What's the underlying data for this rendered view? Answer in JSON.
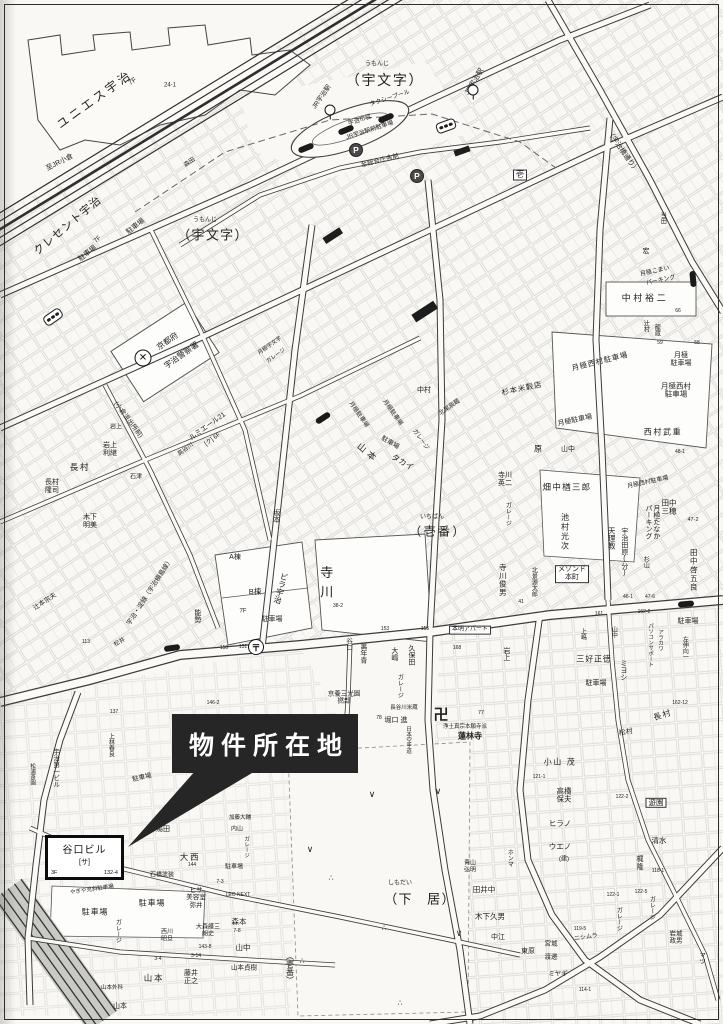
{
  "callout": {
    "label": "物件所在地"
  },
  "property": {
    "name": "谷口ビル",
    "unit": "[サ]",
    "floors": "3F",
    "lot": "132-4"
  },
  "colors": {
    "ink": "#222222",
    "paper": "#f9f8f4",
    "callout_bg": "#262626",
    "callout_text": "#ffffff"
  },
  "labels": [
    {
      "t": "ユニエス宇治",
      "x": 95,
      "y": 100,
      "s": 12,
      "r": -36,
      "ls": 0.25
    },
    {
      "t": "7F",
      "x": 133,
      "y": 82,
      "s": 7,
      "r": -36
    },
    {
      "t": "24-1",
      "x": 170,
      "y": 86,
      "s": 6
    },
    {
      "t": "至JR小倉",
      "x": 60,
      "y": 163,
      "s": 7,
      "r": -27
    },
    {
      "t": "うもんじ",
      "x": 377,
      "y": 65,
      "s": 6
    },
    {
      "t": "（宇文字）",
      "x": 385,
      "y": 81,
      "s": 14,
      "ls": 0.12
    },
    {
      "t": "タクシープール",
      "x": 390,
      "y": 99,
      "s": 6,
      "r": -18
    },
    {
      "t": "JR宇治駅",
      "x": 322,
      "y": 97,
      "s": 6.5,
      "r": -55
    },
    {
      "t": "JR宇治駅",
      "x": 475,
      "y": 82,
      "s": 7,
      "r": -58
    },
    {
      "t": "宇治市営",
      "x": 360,
      "y": 121,
      "s": 6,
      "r": -18
    },
    {
      "t": "JR宇治駅前駐車場",
      "x": 370,
      "y": 131,
      "s": 6,
      "r": -18
    },
    {
      "t": "至総合庁舎前",
      "x": 380,
      "y": 161,
      "s": 6.5,
      "r": -14
    },
    {
      "t": "森田",
      "x": 190,
      "y": 163,
      "s": 6,
      "r": -35
    },
    {
      "t": "うもんじ",
      "x": 205,
      "y": 221,
      "s": 6
    },
    {
      "t": "（宇文字）",
      "x": 213,
      "y": 236,
      "s": 13,
      "ls": 0.1
    },
    {
      "t": "クレセント宇治",
      "x": 68,
      "y": 226,
      "s": 11,
      "r": -40,
      "ls": 0.1
    },
    {
      "t": "7F",
      "x": 98,
      "y": 240,
      "s": 6,
      "r": -40
    },
    {
      "t": "駐車場",
      "x": 136,
      "y": 227,
      "s": 7,
      "r": -38
    },
    {
      "t": "駐車場",
      "x": 88,
      "y": 254,
      "s": 7,
      "r": -38
    },
    {
      "t": "壱",
      "x": 520,
      "y": 175,
      "s": 8,
      "box": 1
    },
    {
      "t": "当田",
      "x": 662,
      "y": 218,
      "s": 6,
      "v": 1
    },
    {
      "t": "宏",
      "x": 646,
      "y": 252,
      "s": 7
    },
    {
      "t": "（宇治橋通り）",
      "x": 622,
      "y": 152,
      "s": 7,
      "r": 55
    },
    {
      "t": "京都府",
      "x": 168,
      "y": 342,
      "s": 8,
      "r": -35
    },
    {
      "t": "宇治警察署",
      "x": 182,
      "y": 356,
      "s": 8,
      "r": -35
    },
    {
      "t": "月極宇文字",
      "x": 270,
      "y": 346,
      "s": 5.5,
      "r": -35
    },
    {
      "t": "ガレージ",
      "x": 276,
      "y": 356,
      "s": 5.5,
      "r": -35
    },
    {
      "t": "中村裕二",
      "x": 645,
      "y": 298,
      "s": 9,
      "ls": 0.3
    },
    {
      "t": "月極こまい",
      "x": 655,
      "y": 272,
      "s": 6,
      "r": -12
    },
    {
      "t": "パーキング",
      "x": 661,
      "y": 281,
      "s": 6,
      "r": -12
    },
    {
      "t": "辻村",
      "x": 645,
      "y": 326,
      "s": 6,
      "v": 1
    },
    {
      "t": "龍蔵",
      "x": 656,
      "y": 330,
      "s": 6,
      "v": 1
    },
    {
      "t": "月極西村駐車場",
      "x": 600,
      "y": 362,
      "s": 7.5,
      "r": -14,
      "ls": 0.1
    },
    {
      "t": "月極\n駐車場",
      "x": 681,
      "y": 360,
      "s": 7
    },
    {
      "t": "月極西村\n駐車場",
      "x": 676,
      "y": 391,
      "s": 7.5
    },
    {
      "t": "西村武重",
      "x": 663,
      "y": 433,
      "s": 8,
      "ls": 0.2
    },
    {
      "t": "66",
      "x": 678,
      "y": 312,
      "s": 5
    },
    {
      "t": "59",
      "x": 660,
      "y": 344,
      "s": 5
    },
    {
      "t": "58",
      "x": 697,
      "y": 344,
      "s": 5
    },
    {
      "t": "48-1",
      "x": 680,
      "y": 453,
      "s": 5
    },
    {
      "t": "中村",
      "x": 424,
      "y": 391,
      "s": 7
    },
    {
      "t": "北尾辰蔵",
      "x": 450,
      "y": 408,
      "s": 6,
      "r": -35
    },
    {
      "t": "杉本米穀店",
      "x": 522,
      "y": 389,
      "s": 7.5,
      "r": -12,
      "ls": 0.1
    },
    {
      "t": "月極駐車場",
      "x": 575,
      "y": 421,
      "s": 7,
      "r": -12
    },
    {
      "t": "原",
      "x": 538,
      "y": 450,
      "s": 8
    },
    {
      "t": "山中",
      "x": 568,
      "y": 450,
      "s": 7
    },
    {
      "t": "寺川\n英二",
      "x": 505,
      "y": 480,
      "s": 7
    },
    {
      "t": "ガレージ",
      "x": 507,
      "y": 514,
      "s": 6,
      "v": 1
    },
    {
      "t": "畑中楢三郎",
      "x": 567,
      "y": 488,
      "s": 8.5,
      "ls": 0.15
    },
    {
      "t": "月極西村駐車場",
      "x": 648,
      "y": 483,
      "s": 6,
      "r": -12
    },
    {
      "t": "池村光次",
      "x": 564,
      "y": 532,
      "s": 8,
      "v": 1,
      "ls": 0.2
    },
    {
      "t": "天理教",
      "x": 611,
      "y": 538,
      "s": 7.5,
      "v": 1
    },
    {
      "t": "宇治田原(分)",
      "x": 624,
      "y": 552,
      "s": 7,
      "v": 1
    },
    {
      "t": "月極たなか\nパーキング",
      "x": 652,
      "y": 522,
      "s": 7,
      "v": 1
    },
    {
      "t": "田中\n三穂",
      "x": 669,
      "y": 508,
      "s": 7.5
    },
    {
      "t": "47-2",
      "x": 693,
      "y": 520,
      "s": 5.5
    },
    {
      "t": "田中啓五良",
      "x": 693,
      "y": 570,
      "s": 7.5,
      "v": 1,
      "ls": 0.15
    },
    {
      "t": "メゾンド\n本町",
      "x": 572,
      "y": 574,
      "s": 7,
      "box": 1
    },
    {
      "t": "寺川俊男",
      "x": 502,
      "y": 580,
      "s": 7.5,
      "v": 1,
      "ls": 0.1
    },
    {
      "t": "北景源太郎",
      "x": 533,
      "y": 582,
      "s": 6,
      "v": 1
    },
    {
      "t": "杉山",
      "x": 645,
      "y": 562,
      "s": 6,
      "v": 1
    },
    {
      "t": "駐車場",
      "x": 688,
      "y": 622,
      "s": 7
    },
    {
      "t": "寺川",
      "x": 325,
      "y": 585,
      "s": 13,
      "v": 1,
      "ls": 0.5
    },
    {
      "t": "A棟",
      "x": 235,
      "y": 558,
      "s": 7
    },
    {
      "t": "B棟",
      "x": 255,
      "y": 592,
      "s": 7.5
    },
    {
      "t": "ビラ宇治",
      "x": 280,
      "y": 588,
      "s": 8,
      "v": 1,
      "r": 15
    },
    {
      "t": "7F",
      "x": 243,
      "y": 612,
      "s": 6
    },
    {
      "t": "駐車場",
      "x": 272,
      "y": 620,
      "s": 7
    },
    {
      "t": "能勢",
      "x": 197,
      "y": 616,
      "s": 7,
      "v": 1
    },
    {
      "t": "宇治・淀線（宇治槇島線）",
      "x": 150,
      "y": 592,
      "s": 6.5,
      "r": -57
    },
    {
      "t": "(小倉派出所前)",
      "x": 128,
      "y": 420,
      "s": 6.5,
      "r": 53
    },
    {
      "t": "ルミエール21",
      "x": 208,
      "y": 427,
      "s": 7,
      "r": -36
    },
    {
      "t": "[ク] 6F",
      "x": 213,
      "y": 440,
      "s": 6,
      "r": -36
    },
    {
      "t": "高谷川",
      "x": 186,
      "y": 450,
      "s": 6,
      "r": -36
    },
    {
      "t": "長村",
      "x": 80,
      "y": 468,
      "s": 8.5,
      "ls": 0.2
    },
    {
      "t": "長村\n隆司",
      "x": 52,
      "y": 487,
      "s": 7
    },
    {
      "t": "岩上\n利継",
      "x": 110,
      "y": 450,
      "s": 7
    },
    {
      "t": "岩上",
      "x": 116,
      "y": 428,
      "s": 6
    },
    {
      "t": "木下\n明美",
      "x": 90,
      "y": 522,
      "s": 7
    },
    {
      "t": "石津",
      "x": 136,
      "y": 478,
      "s": 6
    },
    {
      "t": "山本",
      "x": 368,
      "y": 453,
      "s": 9,
      "r": 40,
      "ls": 0.4
    },
    {
      "t": "タカイ",
      "x": 402,
      "y": 463,
      "s": 8,
      "r": 30
    },
    {
      "t": "駐車場",
      "x": 390,
      "y": 443,
      "s": 6.5,
      "r": 30
    },
    {
      "t": "月極駐車場",
      "x": 358,
      "y": 415,
      "s": 6,
      "r": 55
    },
    {
      "t": "月極駐車場",
      "x": 392,
      "y": 413,
      "s": 6,
      "r": 55
    },
    {
      "t": "ガレージ",
      "x": 420,
      "y": 440,
      "s": 6,
      "r": 55
    },
    {
      "t": "坂本",
      "x": 276,
      "y": 516,
      "s": 7,
      "v": 1
    },
    {
      "t": "いちばん",
      "x": 432,
      "y": 518,
      "s": 6
    },
    {
      "t": "（壱番）",
      "x": 438,
      "y": 532,
      "s": 12,
      "ls": 0.2
    },
    {
      "t": "萬年青",
      "x": 363,
      "y": 653,
      "s": 7,
      "v": 1
    },
    {
      "t": "谷口",
      "x": 348,
      "y": 644,
      "s": 6.5,
      "v": 1
    },
    {
      "t": "大嶋",
      "x": 394,
      "y": 654,
      "s": 7,
      "v": 1
    },
    {
      "t": "久保田",
      "x": 411,
      "y": 655,
      "s": 7,
      "v": 1
    },
    {
      "t": "本明アパート",
      "x": 470,
      "y": 630,
      "s": 6,
      "box": 1
    },
    {
      "t": "岩上",
      "x": 506,
      "y": 654,
      "s": 7,
      "v": 1
    },
    {
      "t": "ガレージ",
      "x": 399,
      "y": 686,
      "s": 6,
      "v": 1
    },
    {
      "t": "京養三光園\n撚部",
      "x": 344,
      "y": 698,
      "s": 6.5
    },
    {
      "t": "長谷川米蔵",
      "x": 404,
      "y": 708,
      "s": 5.5
    },
    {
      "t": "堀口 進",
      "x": 396,
      "y": 721,
      "s": 7
    },
    {
      "t": "卍",
      "x": 441,
      "y": 716,
      "s": 15,
      "b": 1
    },
    {
      "t": "浄土真宗本願寺派",
      "x": 465,
      "y": 727,
      "s": 5.5
    },
    {
      "t": "蓮林寺",
      "x": 470,
      "y": 737,
      "s": 8,
      "b": 1
    },
    {
      "t": "日本空手道",
      "x": 408,
      "y": 740,
      "s": 5.5,
      "v": 1
    },
    {
      "t": "77",
      "x": 481,
      "y": 713,
      "s": 5.5
    },
    {
      "t": "78",
      "x": 379,
      "y": 719,
      "s": 5
    },
    {
      "t": "153",
      "x": 385,
      "y": 630,
      "s": 5
    },
    {
      "t": "155",
      "x": 425,
      "y": 630,
      "s": 5
    },
    {
      "t": "168",
      "x": 457,
      "y": 649,
      "s": 5
    },
    {
      "t": "三好正徳",
      "x": 594,
      "y": 660,
      "s": 8,
      "ls": 0.1
    },
    {
      "t": "ミヨシ",
      "x": 623,
      "y": 670,
      "s": 7,
      "v": 1
    },
    {
      "t": "駐車場",
      "x": 596,
      "y": 684,
      "s": 7
    },
    {
      "t": "左伸向一",
      "x": 684,
      "y": 648,
      "s": 6,
      "v": 1
    },
    {
      "t": "パソコンサポート",
      "x": 650,
      "y": 645,
      "s": 5.5,
      "v": 1
    },
    {
      "t": "アラカワ",
      "x": 660,
      "y": 640,
      "s": 5.5,
      "v": 1
    },
    {
      "t": "山中",
      "x": 613,
      "y": 632,
      "s": 6,
      "v": 1
    },
    {
      "t": "上嶋",
      "x": 582,
      "y": 634,
      "s": 6,
      "v": 1
    },
    {
      "t": "161",
      "x": 599,
      "y": 615,
      "s": 5
    },
    {
      "t": "162-2",
      "x": 644,
      "y": 613,
      "s": 5
    },
    {
      "t": "150",
      "x": 224,
      "y": 649,
      "s": 5
    },
    {
      "t": "151",
      "x": 243,
      "y": 648,
      "s": 5
    },
    {
      "t": "38-2",
      "x": 338,
      "y": 607,
      "s": 5
    },
    {
      "t": "47-6",
      "x": 650,
      "y": 598,
      "s": 5
    },
    {
      "t": "46-1",
      "x": 628,
      "y": 598,
      "s": 5
    },
    {
      "t": "41",
      "x": 521,
      "y": 603,
      "s": 5
    },
    {
      "t": "162-12",
      "x": 680,
      "y": 704,
      "s": 5
    },
    {
      "t": "長村",
      "x": 663,
      "y": 716,
      "s": 8,
      "r": -18,
      "ls": 0.2
    },
    {
      "t": "松村",
      "x": 626,
      "y": 733,
      "s": 7,
      "r": -10
    },
    {
      "t": "小山 茂",
      "x": 560,
      "y": 763,
      "s": 8,
      "ls": 0.2
    },
    {
      "t": "高橋\n保夫",
      "x": 564,
      "y": 796,
      "s": 7.5
    },
    {
      "t": "ヒラノ",
      "x": 560,
      "y": 824,
      "s": 7.5
    },
    {
      "t": "ウエノ",
      "x": 560,
      "y": 847,
      "s": 7.5
    },
    {
      "t": "(建)",
      "x": 564,
      "y": 860,
      "s": 6
    },
    {
      "t": "遊園",
      "x": 656,
      "y": 803,
      "s": 7.5,
      "box": 1
    },
    {
      "t": "清水",
      "x": 659,
      "y": 841,
      "s": 7.5
    },
    {
      "t": "121-1",
      "x": 539,
      "y": 778,
      "s": 5
    },
    {
      "t": "122-2",
      "x": 622,
      "y": 798,
      "s": 5
    },
    {
      "t": "梶\n隆",
      "x": 640,
      "y": 864,
      "s": 7
    },
    {
      "t": "ガレージ",
      "x": 651,
      "y": 908,
      "s": 6,
      "v": 1
    },
    {
      "t": "ガレージ",
      "x": 618,
      "y": 919,
      "s": 6,
      "v": 1
    },
    {
      "t": "ニシムラ",
      "x": 586,
      "y": 938,
      "s": 6,
      "r": -8
    },
    {
      "t": "宮城",
      "x": 551,
      "y": 944,
      "s": 6.5
    },
    {
      "t": "渡邊",
      "x": 551,
      "y": 957,
      "s": 6.5
    },
    {
      "t": "ミヤギ",
      "x": 558,
      "y": 974,
      "s": 6.5
    },
    {
      "t": "岩城\n政男",
      "x": 676,
      "y": 938,
      "s": 6.5
    },
    {
      "t": "マツ",
      "x": 701,
      "y": 958,
      "s": 6.5,
      "v": 1
    },
    {
      "t": "122-1",
      "x": 613,
      "y": 896,
      "s": 5
    },
    {
      "t": "122-5",
      "x": 641,
      "y": 893,
      "s": 5
    },
    {
      "t": "118-1",
      "x": 658,
      "y": 872,
      "s": 5
    },
    {
      "t": "119-5",
      "x": 580,
      "y": 930,
      "s": 5
    },
    {
      "t": "114-1",
      "x": 585,
      "y": 991,
      "s": 5
    },
    {
      "t": "しもだい",
      "x": 400,
      "y": 884,
      "s": 6
    },
    {
      "t": "（下　居）",
      "x": 420,
      "y": 900,
      "s": 13,
      "ls": 0.1
    },
    {
      "t": "青山\n弘明",
      "x": 470,
      "y": 867,
      "s": 6
    },
    {
      "t": "田井中",
      "x": 484,
      "y": 890,
      "s": 7.5
    },
    {
      "t": "木下久男",
      "x": 490,
      "y": 917,
      "s": 7.5
    },
    {
      "t": "ホンマ",
      "x": 509,
      "y": 858,
      "s": 6,
      "v": 1
    },
    {
      "t": "中江",
      "x": 498,
      "y": 938,
      "s": 7
    },
    {
      "t": "東原",
      "x": 528,
      "y": 952,
      "s": 7
    },
    {
      "t": "湯田",
      "x": 163,
      "y": 830,
      "s": 7
    },
    {
      "t": "大西",
      "x": 190,
      "y": 858,
      "s": 8.5,
      "ls": 0.2
    },
    {
      "t": "石橋塗装",
      "x": 162,
      "y": 876,
      "s": 6
    },
    {
      "t": "ヒサ\n美容室\n弥井",
      "x": 196,
      "y": 898,
      "s": 6.5
    },
    {
      "t": "やぎや児斜駐車場",
      "x": 92,
      "y": 890,
      "s": 5.5,
      "r": -8
    },
    {
      "t": "駐車場",
      "x": 95,
      "y": 913,
      "s": 8,
      "ls": 0.1
    },
    {
      "t": "駐車場",
      "x": 152,
      "y": 904,
      "s": 8,
      "ls": 0.1
    },
    {
      "t": "西川\n昭旦",
      "x": 167,
      "y": 936,
      "s": 6
    },
    {
      "t": "大森護三\n朗史",
      "x": 208,
      "y": 931,
      "s": 6
    },
    {
      "t": "森本",
      "x": 239,
      "y": 922,
      "s": 7.5
    },
    {
      "t": "山中",
      "x": 243,
      "y": 948,
      "s": 7.5
    },
    {
      "t": "山本貞樹",
      "x": 244,
      "y": 968,
      "s": 6.5
    },
    {
      "t": "山本",
      "x": 154,
      "y": 979,
      "s": 8.5,
      "ls": 0.2
    },
    {
      "t": "藤井\n正之",
      "x": 191,
      "y": 978,
      "s": 7
    },
    {
      "t": "ガレージ",
      "x": 117,
      "y": 931,
      "s": 6,
      "v": 1
    },
    {
      "t": "LEO NEXT",
      "x": 238,
      "y": 896,
      "s": 5
    },
    {
      "t": "山本外科",
      "x": 112,
      "y": 988,
      "s": 5.5
    },
    {
      "t": "山本",
      "x": 120,
      "y": 1007,
      "s": 7
    },
    {
      "t": "7-8",
      "x": 237,
      "y": 932,
      "s": 5
    },
    {
      "t": "143-8",
      "x": 205,
      "y": 948,
      "s": 5
    },
    {
      "t": "3-4",
      "x": 158,
      "y": 960,
      "s": 5
    },
    {
      "t": "3-14",
      "x": 196,
      "y": 957,
      "s": 5
    },
    {
      "t": "144",
      "x": 192,
      "y": 866,
      "s": 5
    },
    {
      "t": "7-3",
      "x": 220,
      "y": 883,
      "s": 5
    },
    {
      "t": "146-2",
      "x": 213,
      "y": 704,
      "s": 5
    },
    {
      "t": "加藤大輔",
      "x": 240,
      "y": 818,
      "s": 5.5
    },
    {
      "t": "内山",
      "x": 237,
      "y": 830,
      "s": 6
    },
    {
      "t": "ガレージ",
      "x": 246,
      "y": 847,
      "s": 5.5,
      "v": 1
    },
    {
      "t": "駐車場",
      "x": 234,
      "y": 868,
      "s": 6
    },
    {
      "t": "宇治第一ビル",
      "x": 55,
      "y": 768,
      "s": 6.5,
      "v": 1
    },
    {
      "t": "上林春良",
      "x": 110,
      "y": 745,
      "s": 6,
      "v": 1
    },
    {
      "t": "松浦茶園",
      "x": 32,
      "y": 774,
      "s": 5.5,
      "v": 1
    },
    {
      "t": "駐車場",
      "x": 142,
      "y": 778,
      "s": 6.5,
      "r": -12
    },
    {
      "t": "辻本宗夫",
      "x": 45,
      "y": 602,
      "s": 6.5,
      "r": -33
    },
    {
      "t": "松井",
      "x": 120,
      "y": 643,
      "s": 6,
      "r": -30
    },
    {
      "t": "137",
      "x": 114,
      "y": 713,
      "s": 5
    },
    {
      "t": "113",
      "x": 86,
      "y": 643,
      "s": 5
    },
    {
      "t": "（壱番）",
      "x": 289,
      "y": 968,
      "s": 8,
      "v": 1
    },
    {
      "t": "∨",
      "x": 372,
      "y": 794,
      "s": 9
    },
    {
      "t": "∨",
      "x": 438,
      "y": 791,
      "s": 9
    },
    {
      "t": "∨",
      "x": 310,
      "y": 849,
      "s": 9
    },
    {
      "t": "∨",
      "x": 459,
      "y": 933,
      "s": 9
    },
    {
      "t": "∴",
      "x": 331,
      "y": 879,
      "s": 8
    },
    {
      "t": "∴",
      "x": 384,
      "y": 929,
      "s": 8
    },
    {
      "t": "∴",
      "x": 400,
      "y": 1004,
      "s": 8
    },
    {
      "t": "∴",
      "x": 302,
      "y": 962,
      "s": 8
    }
  ],
  "icons": [
    {
      "type": "police",
      "x": 143,
      "y": 358,
      "glyph": "✕"
    },
    {
      "type": "post",
      "x": 256,
      "y": 647,
      "glyph": "〒"
    },
    {
      "type": "parking",
      "x": 356,
      "y": 150,
      "glyph": "P"
    },
    {
      "type": "parking",
      "x": 417,
      "y": 176,
      "glyph": "P"
    },
    {
      "type": "signal",
      "x": 53,
      "y": 317,
      "r": -35
    },
    {
      "type": "signal",
      "x": 446,
      "y": 126,
      "r": -20
    },
    {
      "type": "busstop",
      "x": 323,
      "y": 418,
      "r": -33
    },
    {
      "type": "busstop",
      "x": 172,
      "y": 648,
      "r": -8
    },
    {
      "type": "busstop",
      "x": 686,
      "y": 604,
      "r": -5
    },
    {
      "type": "busstop",
      "x": 693,
      "y": 279,
      "r": 85
    },
    {
      "type": "busstop",
      "x": 306,
      "y": 148,
      "r": -22
    },
    {
      "type": "busstop",
      "x": 346,
      "y": 130,
      "r": -22
    },
    {
      "type": "busstop",
      "x": 386,
      "y": 118,
      "r": -22
    },
    {
      "type": "station",
      "x": 330,
      "y": 110
    },
    {
      "type": "station",
      "x": 473,
      "y": 90
    }
  ]
}
